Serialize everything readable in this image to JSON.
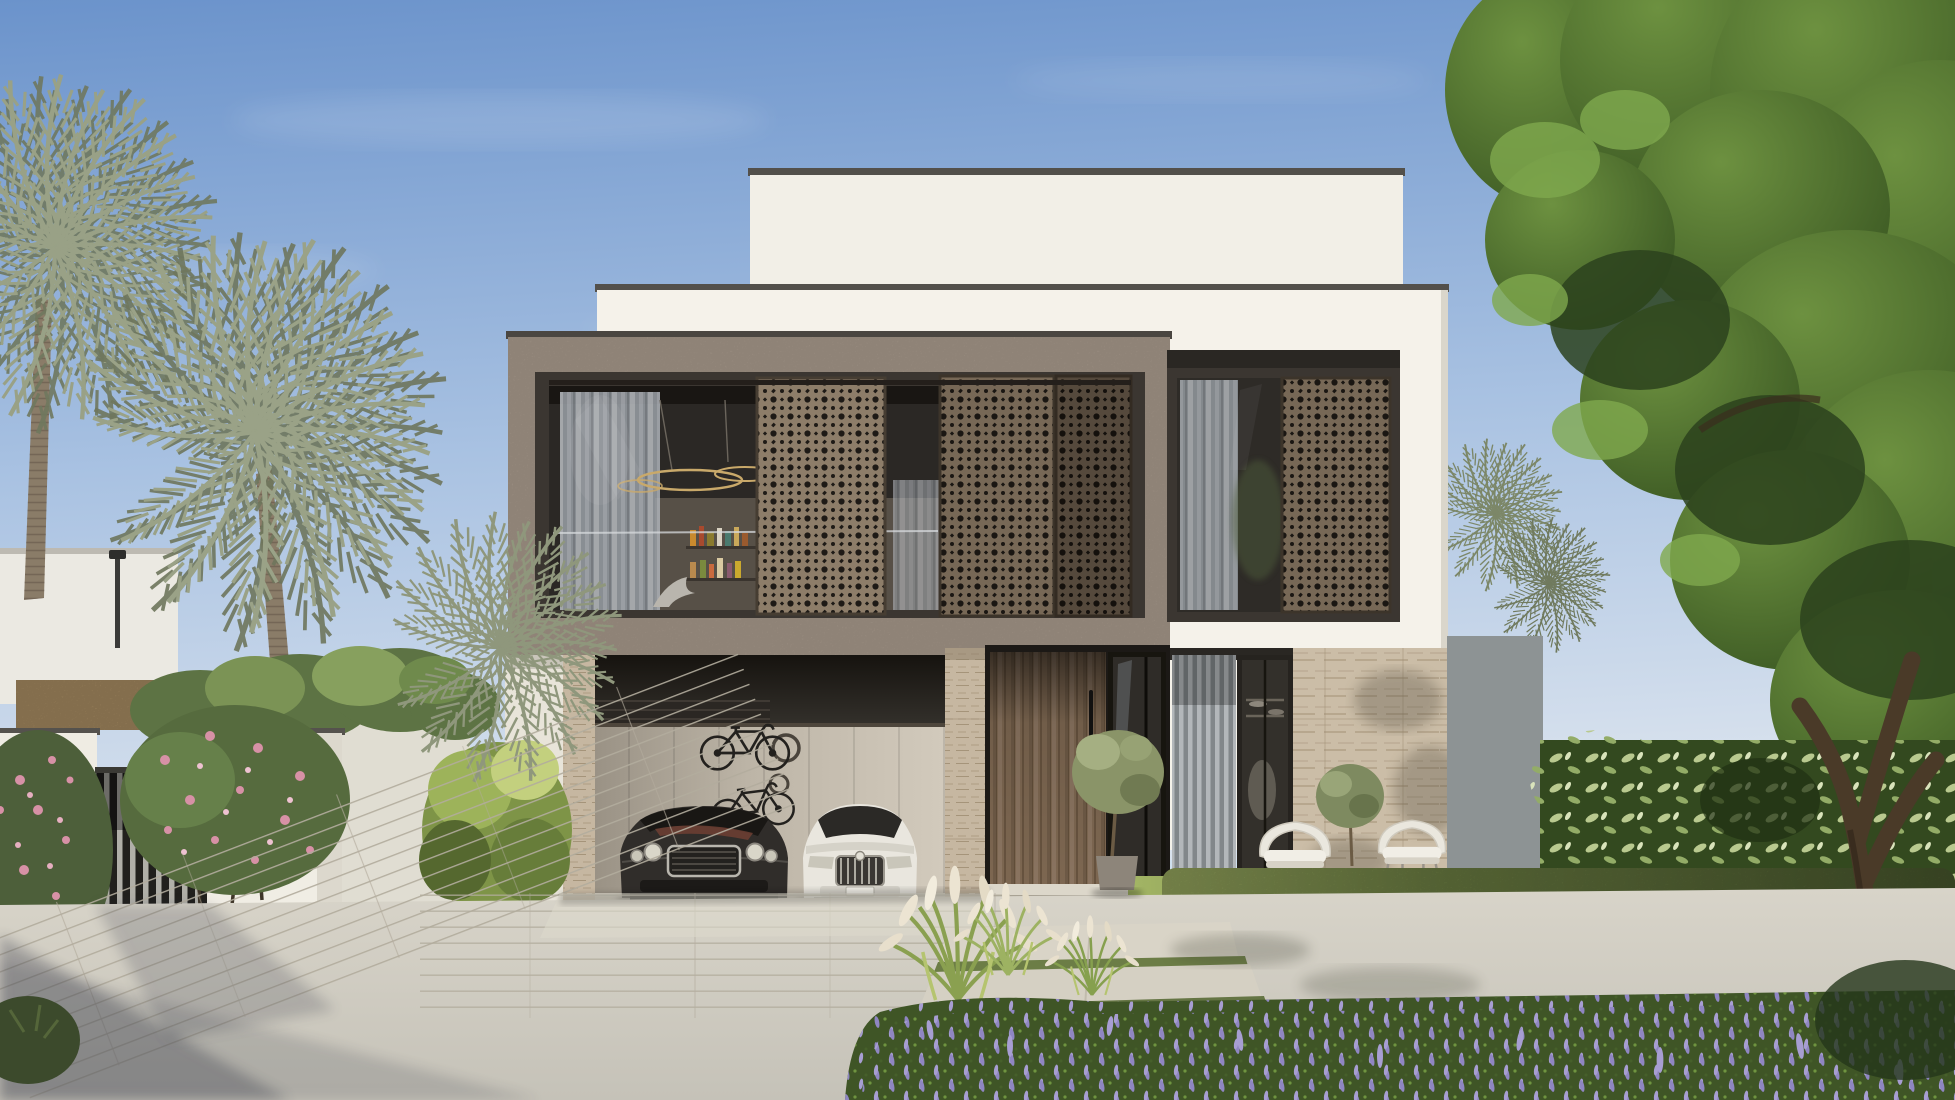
{
  "scene": {
    "title": "Modern two-storey luxury villa — photorealistic exterior rendering",
    "time_of_day": "daytime, clear sky",
    "style": "contemporary Middle-Eastern villa with mashrabiya screens",
    "objects": [
      "white stacked roof volumes with dark coping",
      "taupe stone upper-floor box with perforated mashrabiya sliding screens",
      "upper-floor glass wall with curtains, ring chandelier, drinks shelf and eagle sculpture",
      "recessed upper window on right white volume with screen and curtain",
      "double garage with dark luxury coupe and white luxury sedan",
      "two bicycles mounted on garage wall",
      "round wall decor in garage",
      "travertine stone columns and wall",
      "tall timber entrance door with black pull handle and glass sidelight",
      "potted olive tree by entrance",
      "louvered ground window and glass door",
      "two white wicker armchairs with cushions and small olive tree",
      "trimmed hedge, lawn, white plume grass bed, purple flower groundcover",
      "fountain grass clumps",
      "paved plank driveway with stepping-stone path and grass joints",
      "white boundary wall with dark slatted gate",
      "pink flowering shrubs",
      "date palm trees",
      "large green tree on right"
    ]
  },
  "colors": {
    "sky_top": "#6b93cb",
    "sky_mid": "#a9c2e2",
    "sky_horizon": "#dae3ee",
    "white_wall": "#f5f2ea",
    "white_wall_2": "#f2efe7",
    "coping": "#53504b",
    "taupe_box": "#a89a8c",
    "frame_bronze": "#3b3631",
    "glass_dark": "#2b2825",
    "curtain": "#aeb3b9",
    "mash_light": "#8d7d69",
    "mash_mid": "#77685639",
    "mash_mid_solid": "#776856",
    "mash_dark": "#55493c",
    "mash_hole": "#1e1a16",
    "travertine": "#c6b7a1",
    "travertine_wall": "#cbbda7",
    "wood_door": "#7d6751",
    "garage_wall": "#c8c0b2",
    "garage_header": "#1d1a17",
    "car_dark": "#302d2a",
    "car_white": "#e9e6de",
    "chrome": "#b9b6ae",
    "driveway": "#cfccc3",
    "paver_joint": "#b2ac9d",
    "step_stone": "#dcd7ca",
    "path_grass": "#6c7d46",
    "hedge": "#66793f",
    "lawn": "#8ca153",
    "tree_dark": "#2f4520",
    "tree_mid": "#49672e",
    "tree_light": "#6d9140",
    "palm_leaf": "#99a186",
    "palm_trunk": "#8a7c68",
    "pink_flower": "#d791a6",
    "lavender": "#8f86c2",
    "plume": "#ece4d2",
    "gray_wall": "#8d9394",
    "gate_dark": "#21201d",
    "gate_slat": "#b0afa8",
    "neighbor_wall": "#ebe9e2",
    "tan_wall": "#b19468",
    "pot": "#8d857a"
  }
}
